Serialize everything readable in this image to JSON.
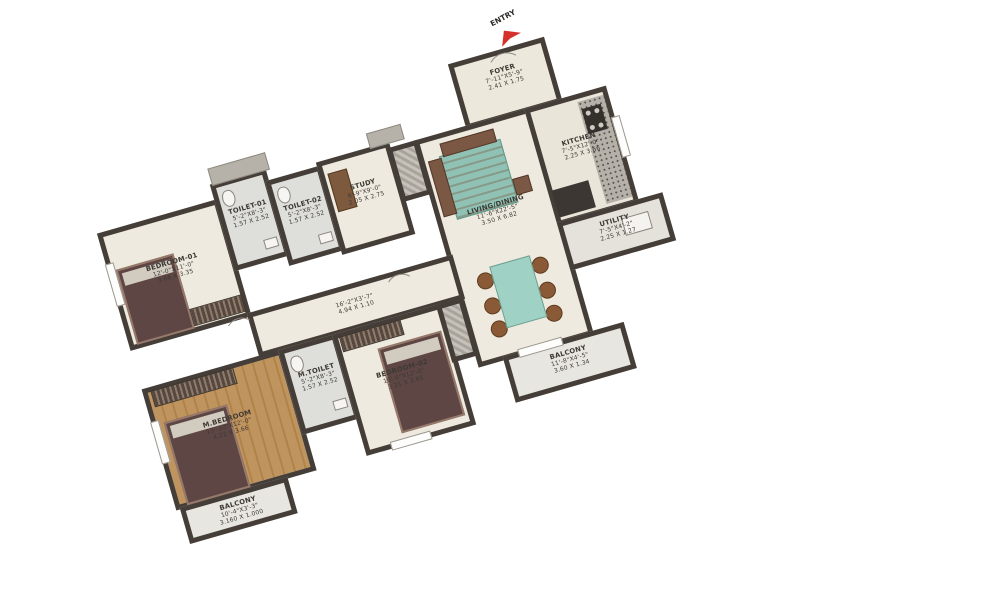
{
  "title": "3BHK apartment floor plan",
  "entry": {
    "label": "ENTRY",
    "arrow_color": "#d6322c"
  },
  "colors": {
    "wall": "#453e38",
    "floor": "#efeadf",
    "wood_floor": "#b98a58",
    "tile": "#dededa",
    "dining_table": "#9fd2c4",
    "furniture_dark": "#5e4644",
    "entry_arrow": "#d6322c"
  },
  "rooms": {
    "foyer": {
      "name": "FOYER",
      "dim_ft": "7'-11\"X5'-9\"",
      "dim_m": "2.41 X 1.75"
    },
    "kitchen": {
      "name": "KITCHEN",
      "dim_ft": "7'-5\"X12'-0\"",
      "dim_m": "2.25 X 3.66"
    },
    "utility": {
      "name": "UTILITY",
      "dim_ft": "7'-5\"X4'-2\"",
      "dim_m": "2.25 X 1.27"
    },
    "living": {
      "name": "LIVING/DINING",
      "dim_ft": "11'-6\"X22'-5\"",
      "dim_m": "3.50 X 6.82"
    },
    "balcony_right": {
      "name": "BALCONY",
      "dim_ft": "11'-8\"X4'-5\"",
      "dim_m": "3.60 X 1.34"
    },
    "toilet_01": {
      "name": "TOILET-01",
      "dim_ft": "5'-2\"X8'-3\"",
      "dim_m": "1.57 X 2.52"
    },
    "toilet_02": {
      "name": "TOILET-02",
      "dim_ft": "5'-2\"X8'-3\"",
      "dim_m": "1.57 X 2.52"
    },
    "study": {
      "name": "STUDY",
      "dim_ft": "6'-9\"X9'-0\"",
      "dim_m": "2.05 X 2.75"
    },
    "bedroom_01": {
      "name": "BEDROOM-01",
      "dim_ft": "12'-0\"X11'-0\"",
      "dim_m": "3.66 X 3.35"
    },
    "passage": {
      "name": "",
      "dim_ft": "16'-2\"X3'-7\"",
      "dim_m": "4.94 X 1.10"
    },
    "m_bedroom": {
      "name": "M.BEDROOM",
      "dim_ft": "13'-10\"X12'-0\"",
      "dim_m": "4.22 X 3.66"
    },
    "m_toilet": {
      "name": "M.TOILET",
      "dim_ft": "5'-2\"X8'-3\"",
      "dim_m": "1.57 X 2.52"
    },
    "bedroom_02": {
      "name": "BEDROOM-02",
      "dim_ft": "10'-6\"X12'-0\"",
      "dim_m": "3.21 X 3.65"
    },
    "balcony_bottom": {
      "name": "BALCONY",
      "dim_ft": "10'-4\"X3'-3\"",
      "dim_m": "3.160 X 1.000"
    }
  }
}
